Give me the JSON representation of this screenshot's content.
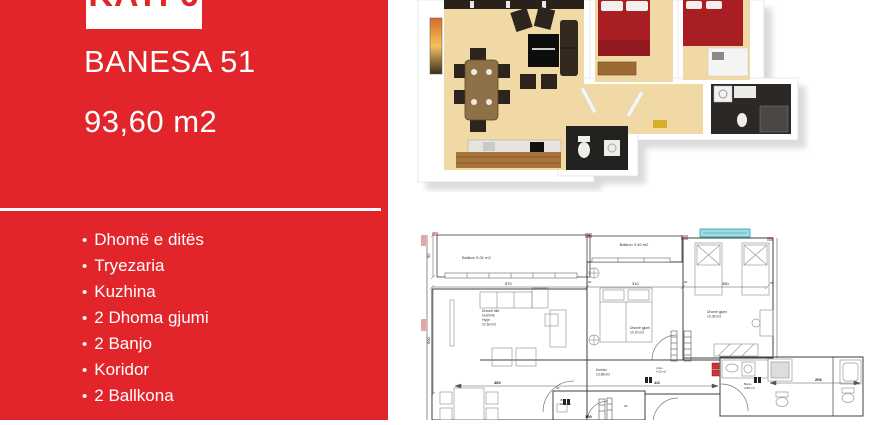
{
  "flyer": {
    "floor_badge": "KATI 6",
    "title": "BANESA 51",
    "area": "93,60 m2",
    "bullet": "•",
    "rooms": [
      "Dhomë e ditës",
      "Tryezaria",
      "Kuzhina",
      "2 Dhoma gjumi",
      "2 Banjo",
      "Koridor",
      "2 Ballkona"
    ],
    "colors": {
      "sidebar_red": "#e2252b",
      "text_white": "#ffffff",
      "bed_red": "#a81e23",
      "floor_beige": "#f0d9a4",
      "window_cyan": "#9fdde2",
      "radiator_red": "#cf3333"
    }
  },
  "plan2d": {
    "labels": {
      "balcony_left": "Ballkon 5.01 m2",
      "balcony_top": "Ballkon 3.40 m2",
      "living_1": "Dhomë dite",
      "living_2": "Guzhinë",
      "living_3": "Hyrje",
      "living_4": "22.60 m2",
      "bedroom_mid_1": "Dhomë gjumi",
      "bedroom_mid_2": "10.20 m2",
      "bedroom_right_1": "Dhomë gjumi",
      "bedroom_right_2": "10.36 m2",
      "corridor_1": "Koridor",
      "corridor_2": "13.88 m2",
      "hall_1": "Antre",
      "hall_2": "4.20 m2",
      "bath_1": "Banjo",
      "bath_2": "4.85 m2",
      "wc_1": "WC",
      "wc_2": "2.80 m2"
    },
    "dimensions": {
      "top": [
        "570",
        "310",
        "380"
      ],
      "left": [
        "90",
        "500"
      ],
      "corridor": [
        "460",
        "412",
        "190"
      ],
      "bath": "206",
      "right": "25",
      "wall": "20"
    }
  }
}
